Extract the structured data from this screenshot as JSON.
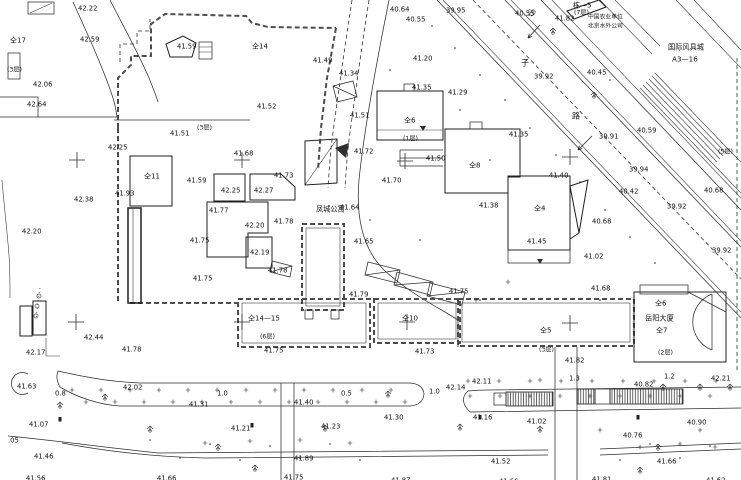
{
  "map": {
    "colors": {
      "line": "#2e2e2e",
      "text": "#101010",
      "fence": "#4d4d4d",
      "background": "#ffffff"
    },
    "label_kinds": {
      "e": "spot-elevation",
      "d": "road-width",
      "b": "building-number",
      "f": "floor-count",
      "n": "place-name",
      "r": "road-name-character"
    },
    "labels": [
      [
        78,
        5,
        "42.22",
        "e"
      ],
      [
        80,
        36,
        "42.59",
        "e"
      ],
      [
        33,
        81,
        "42.06",
        "e"
      ],
      [
        27,
        101,
        "42.64",
        "e"
      ],
      [
        108,
        144,
        "42.25",
        "e"
      ],
      [
        74,
        196,
        "42.38",
        "e"
      ],
      [
        22,
        228,
        "42.20",
        "e"
      ],
      [
        115,
        190,
        "41.93",
        "e"
      ],
      [
        177,
        43,
        "41.59",
        "e"
      ],
      [
        170,
        130,
        "41.51",
        "e"
      ],
      [
        257,
        103,
        "41.52",
        "e"
      ],
      [
        313,
        57,
        "41.49",
        "e"
      ],
      [
        350,
        112,
        "41.51",
        "e"
      ],
      [
        390,
        6,
        "40.64",
        "e"
      ],
      [
        406,
        16,
        "40.55",
        "e"
      ],
      [
        446,
        7,
        "39.95",
        "e"
      ],
      [
        413,
        55,
        "41.20",
        "e"
      ],
      [
        339,
        70,
        "41.34",
        "e"
      ],
      [
        412,
        84,
        "41.35",
        "e"
      ],
      [
        448,
        89,
        "41.29",
        "e"
      ],
      [
        509,
        131,
        "41.35",
        "e"
      ],
      [
        354,
        148,
        "41.72",
        "e"
      ],
      [
        382,
        177,
        "41.70",
        "e"
      ],
      [
        340,
        204,
        "41.64",
        "e"
      ],
      [
        354,
        238,
        "41.65",
        "e"
      ],
      [
        349,
        291,
        "41.79",
        "e"
      ],
      [
        274,
        172,
        "41.73",
        "e"
      ],
      [
        187,
        177,
        "41.59",
        "e"
      ],
      [
        221,
        187,
        "42.25",
        "e"
      ],
      [
        254,
        187,
        "42.27",
        "e"
      ],
      [
        209,
        207,
        "41.77",
        "e"
      ],
      [
        245,
        222,
        "42.20",
        "e"
      ],
      [
        274,
        218,
        "41.78",
        "e"
      ],
      [
        190,
        237,
        "41.75",
        "e"
      ],
      [
        250,
        249,
        "42.19",
        "e"
      ],
      [
        268,
        267,
        "41.78",
        "e"
      ],
      [
        193,
        275,
        "41.75",
        "e"
      ],
      [
        234,
        150,
        "41.68",
        "e"
      ],
      [
        426,
        155,
        "41.50",
        "e"
      ],
      [
        479,
        202,
        "41.38",
        "e"
      ],
      [
        549,
        172,
        "41.40",
        "e"
      ],
      [
        592,
        218,
        "40.68",
        "e"
      ],
      [
        527,
        238,
        "41.45",
        "e"
      ],
      [
        584,
        253,
        "41.02",
        "e"
      ],
      [
        591,
        285,
        "41.68",
        "e"
      ],
      [
        449,
        288,
        "41.75",
        "e"
      ],
      [
        534,
        73,
        "39.92",
        "e"
      ],
      [
        587,
        69,
        "40.45",
        "e"
      ],
      [
        637,
        127,
        "40.59",
        "e"
      ],
      [
        599,
        133,
        "39.91",
        "e"
      ],
      [
        629,
        166,
        "39.94",
        "e"
      ],
      [
        619,
        188,
        "40.42",
        "e"
      ],
      [
        667,
        203,
        "39.92",
        "e"
      ],
      [
        704,
        187,
        "40.68",
        "e"
      ],
      [
        712,
        247,
        "39.92",
        "e"
      ],
      [
        515,
        10,
        "40.55",
        "e"
      ],
      [
        555,
        15,
        "41.82",
        "e"
      ],
      [
        264,
        347,
        "41.75",
        "e"
      ],
      [
        415,
        348,
        "41.73",
        "e"
      ],
      [
        565,
        357,
        "41.82",
        "e"
      ],
      [
        711,
        375,
        "42.21",
        "e"
      ],
      [
        634,
        381,
        "40.82",
        "e"
      ],
      [
        26,
        349,
        "42.17",
        "e"
      ],
      [
        84,
        334,
        "42.44",
        "e"
      ],
      [
        122,
        346,
        "41.78",
        "e"
      ],
      [
        17,
        383,
        "41.63",
        "e"
      ],
      [
        123,
        384,
        "42.02",
        "e"
      ],
      [
        189,
        401,
        "41.31",
        "e"
      ],
      [
        294,
        399,
        "41.40",
        "e"
      ],
      [
        29,
        421,
        "41.07",
        "e"
      ],
      [
        231,
        425,
        "41.21",
        "e"
      ],
      [
        321,
        423,
        "41.23",
        "e"
      ],
      [
        34,
        453,
        "41.46",
        "e"
      ],
      [
        294,
        455,
        "41.89",
        "e"
      ],
      [
        26,
        475,
        "41.56",
        "e"
      ],
      [
        157,
        475,
        "41.66",
        "e"
      ],
      [
        284,
        474,
        "41.75",
        "e"
      ],
      [
        446,
        384,
        "42.14",
        "e"
      ],
      [
        472,
        378,
        "42.11",
        "e"
      ],
      [
        384,
        414,
        "41.30",
        "e"
      ],
      [
        473,
        414,
        "41.16",
        "e"
      ],
      [
        527,
        418,
        "41.02",
        "e"
      ],
      [
        687,
        419,
        "40.90",
        "e"
      ],
      [
        623,
        432,
        "40.76",
        "e"
      ],
      [
        491,
        458,
        "41.52",
        "e"
      ],
      [
        657,
        458,
        "41.66",
        "e"
      ],
      [
        391,
        477,
        "41.87",
        "e"
      ],
      [
        499,
        478,
        "41.66",
        "e"
      ],
      [
        592,
        476,
        "41.81",
        "e"
      ],
      [
        706,
        477,
        "41.62",
        "e"
      ],
      [
        8,
        437,
        ".05",
        "e"
      ],
      [
        55,
        390,
        "0.8",
        "d"
      ],
      [
        217,
        390,
        "1.0",
        "d"
      ],
      [
        341,
        390,
        "0.5",
        "d"
      ],
      [
        429,
        388,
        "1.0",
        "d"
      ],
      [
        569,
        375,
        "1.3",
        "d"
      ],
      [
        664,
        373,
        "1.2",
        "d"
      ],
      [
        10,
        37,
        "仝17",
        "b"
      ],
      [
        252,
        43,
        "仝14",
        "b"
      ],
      [
        144,
        173,
        "仝11",
        "b"
      ],
      [
        404,
        117,
        "仝6",
        "b"
      ],
      [
        469,
        162,
        "仝8",
        "b"
      ],
      [
        534,
        205,
        "仝4",
        "b"
      ],
      [
        248,
        315,
        "仝14—15",
        "b"
      ],
      [
        402,
        315,
        "仝10",
        "b"
      ],
      [
        540,
        327,
        "仝5",
        "b"
      ],
      [
        656,
        327,
        "仝7",
        "b"
      ],
      [
        655,
        300,
        "仝6",
        "b"
      ],
      [
        573,
        2,
        "栋—5",
        "b"
      ],
      [
        7,
        66,
        "(3层)",
        "f"
      ],
      [
        197,
        124,
        "(3层)",
        "f"
      ],
      [
        574,
        9,
        "(7层)",
        "f"
      ],
      [
        403,
        135,
        "(1层)",
        "f"
      ],
      [
        718,
        148,
        "(5层)",
        "f"
      ],
      [
        260,
        333,
        "(6层)",
        "f"
      ],
      [
        539,
        346,
        "(3层)",
        "f"
      ],
      [
        658,
        349,
        "(2层)",
        "f"
      ],
      [
        316,
        206,
        "凤城公寓",
        "n"
      ],
      [
        645,
        315,
        "岳阳大厦",
        "n"
      ],
      [
        588,
        13,
        "中国农业单位",
        "n2"
      ],
      [
        588,
        22,
        "北京水外公司",
        "n2"
      ],
      [
        668,
        44,
        "国际风具城",
        "n"
      ],
      [
        672,
        56,
        "A3—16",
        "n"
      ],
      [
        528,
        10,
        "沙",
        "r"
      ],
      [
        521,
        60,
        "子",
        "r"
      ],
      [
        572,
        113,
        "路",
        "r"
      ]
    ],
    "survey_crosses": [
      [
        77,
        160
      ],
      [
        242,
        160
      ],
      [
        405,
        161
      ],
      [
        570,
        157
      ],
      [
        76,
        322
      ],
      [
        242,
        322
      ],
      [
        407,
        322
      ],
      [
        570,
        323
      ]
    ],
    "tick_rows": [
      {
        "y": 390,
        "x0": 72,
        "x1": 414,
        "step": 29
      },
      {
        "y": 402,
        "x0": 86,
        "x1": 414,
        "step": 29
      },
      {
        "y": 396,
        "x0": 470,
        "x1": 734,
        "step": 30
      },
      {
        "y": 381,
        "x0": 468,
        "x1": 734,
        "step": 31
      }
    ],
    "scatter_ticks": [
      [
        205,
        443
      ],
      [
        250,
        441
      ],
      [
        300,
        440
      ],
      [
        350,
        443
      ],
      [
        640,
        447
      ],
      [
        680,
        444
      ],
      [
        715,
        447
      ],
      [
        540,
        380
      ],
      [
        600,
        430
      ],
      [
        700,
        430
      ],
      [
        508,
        282
      ],
      [
        476,
        300
      ]
    ],
    "dots": [
      [
        432,
        26
      ],
      [
        455,
        48
      ],
      [
        480,
        75
      ],
      [
        505,
        100
      ],
      [
        530,
        128
      ],
      [
        556,
        155
      ],
      [
        580,
        182
      ],
      [
        605,
        210
      ],
      [
        630,
        237
      ],
      [
        655,
        263
      ],
      [
        150,
        440
      ],
      [
        180,
        458
      ],
      [
        210,
        444
      ],
      [
        240,
        460
      ],
      [
        270,
        446
      ],
      [
        300,
        458
      ],
      [
        330,
        444
      ],
      [
        360,
        460
      ],
      [
        620,
        460
      ],
      [
        650,
        444
      ],
      [
        680,
        458
      ],
      [
        710,
        446
      ],
      [
        390,
        70
      ],
      [
        370,
        220
      ],
      [
        420,
        240
      ],
      [
        600,
        300
      ],
      [
        460,
        110
      ],
      [
        490,
        160
      ],
      [
        610,
        80
      ],
      [
        480,
        300
      ]
    ],
    "trees": [
      [
        105,
        398
      ],
      [
        150,
        430
      ],
      [
        218,
        448
      ],
      [
        255,
        469
      ],
      [
        325,
        429
      ],
      [
        388,
        395
      ],
      [
        540,
        430
      ],
      [
        658,
        448
      ],
      [
        700,
        388
      ],
      [
        640,
        471
      ],
      [
        460,
        428
      ],
      [
        60,
        406
      ],
      [
        553,
        32
      ],
      [
        594,
        96
      ],
      [
        663,
        388
      ],
      [
        730,
        388
      ]
    ],
    "marker_squares": [
      [
        60,
        419
      ],
      [
        252,
        425
      ],
      [
        480,
        417
      ],
      [
        638,
        417
      ]
    ],
    "survey_circles": [
      [
        39,
        296
      ],
      [
        37,
        306
      ],
      [
        36,
        316
      ]
    ],
    "arrows": [
      {
        "x1": 592,
        "y1": 136,
        "x2": 578,
        "y2": 150
      },
      {
        "x1": 540,
        "y1": 25,
        "x2": 528,
        "y2": 38
      }
    ]
  }
}
